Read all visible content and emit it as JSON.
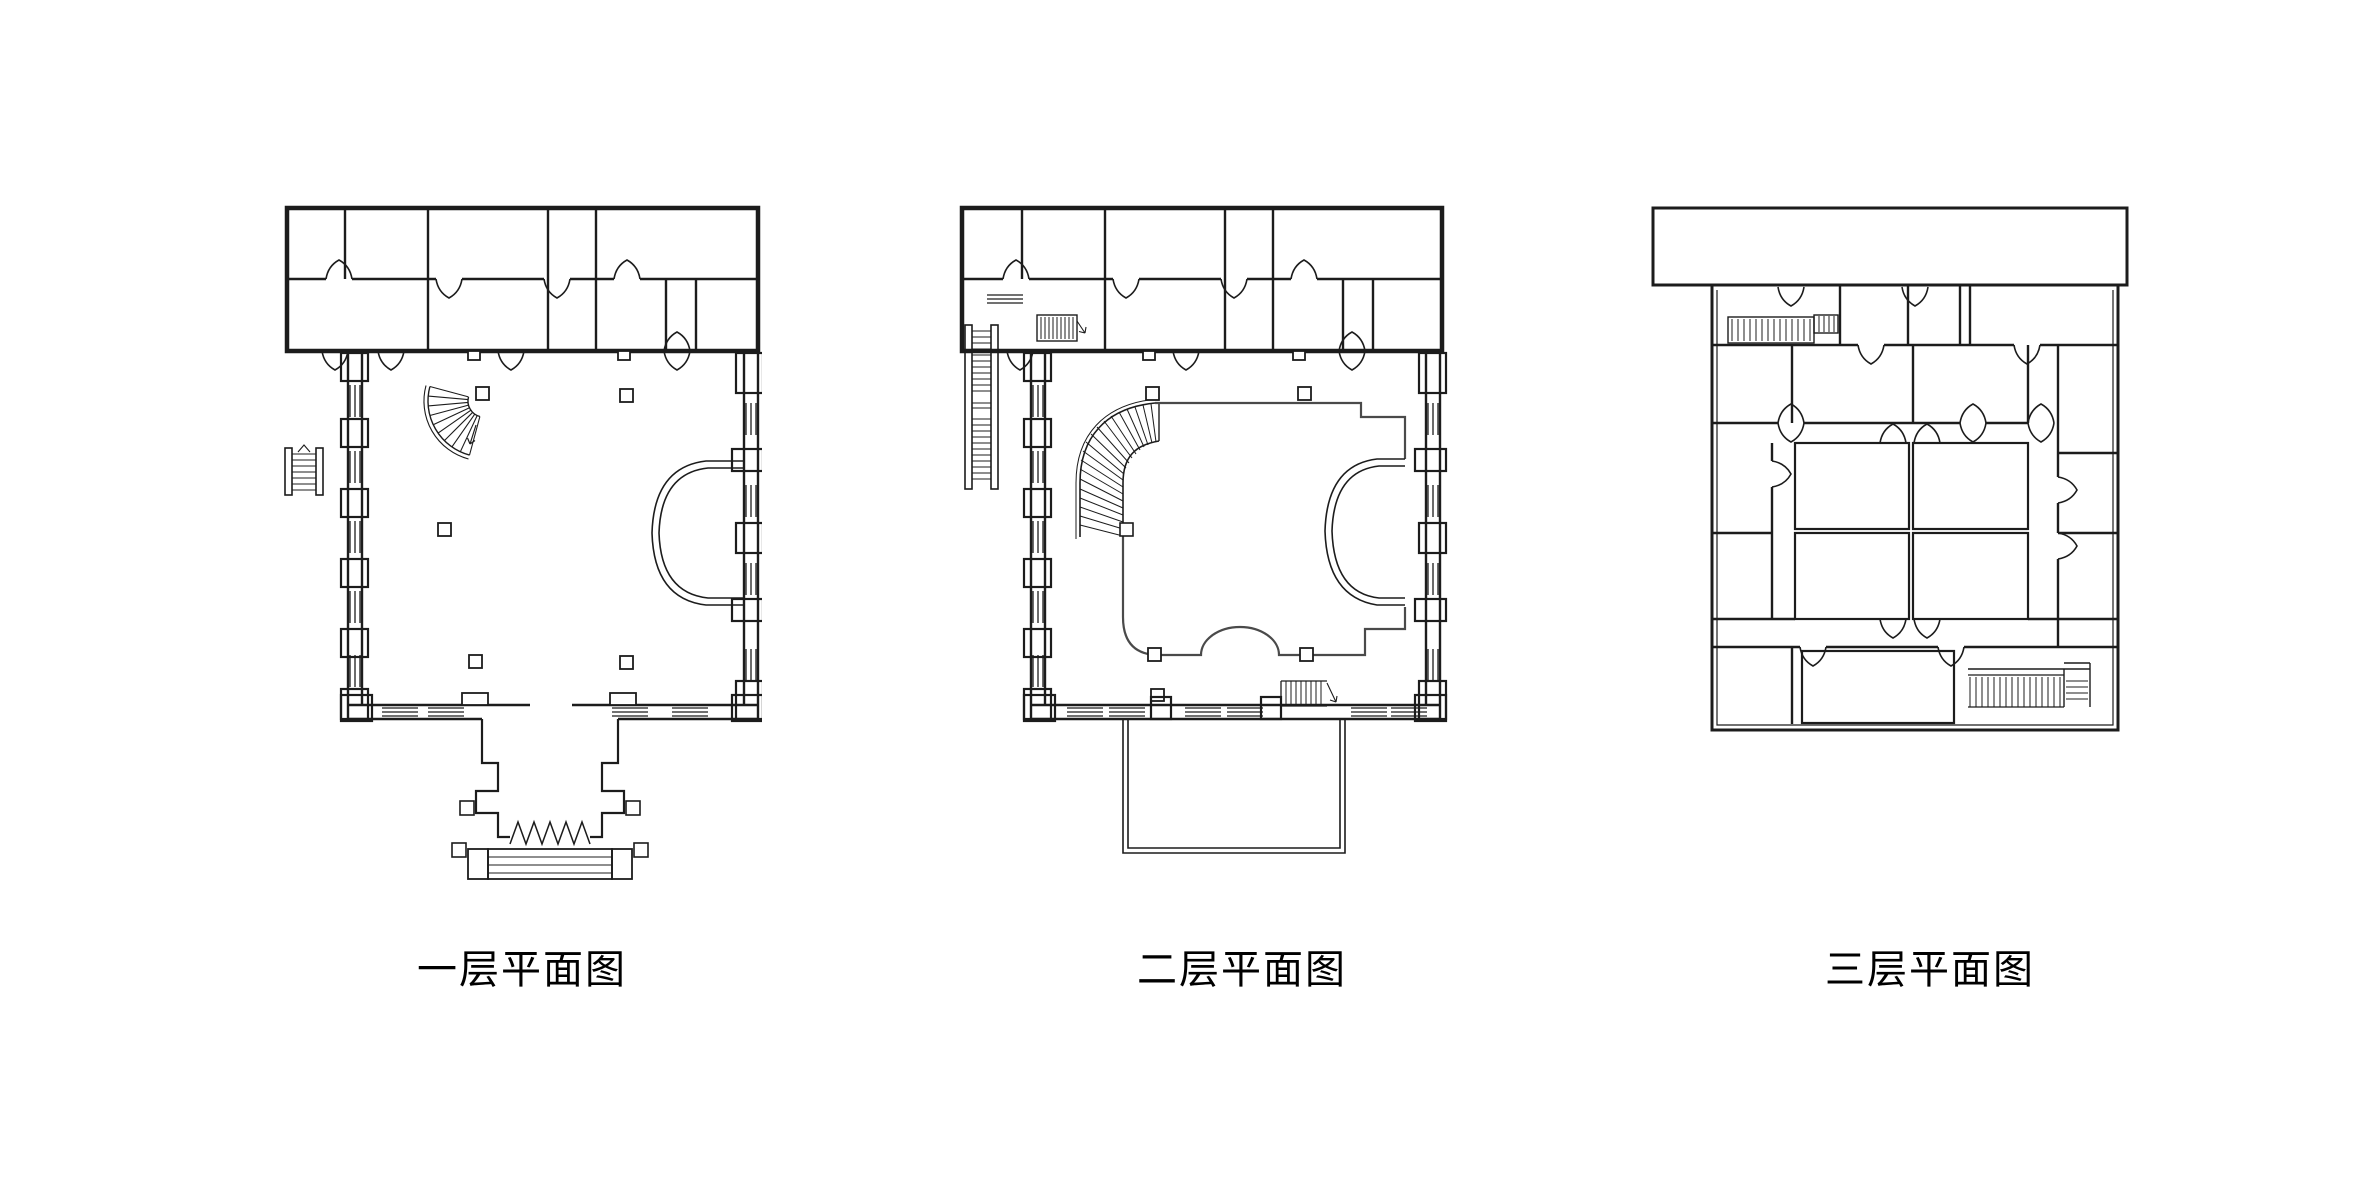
{
  "page": {
    "background_color": "#ffffff",
    "line_color": "#1c1c1c",
    "gallery_line_color": "#4a4a4a"
  },
  "plans": [
    {
      "id": "floor-1",
      "label": "一层平面图",
      "features": [
        "top-wing-rooms",
        "main-hall",
        "fan-staircase",
        "columns",
        "stage-apse",
        "entrance-portico",
        "entrance-steps",
        "exterior-stair",
        "windows",
        "door-swings"
      ]
    },
    {
      "id": "floor-2",
      "label": "二层平面图",
      "features": [
        "top-wing-rooms",
        "gallery-balcony",
        "grand-curved-staircase",
        "columns",
        "stage-apse",
        "side-exterior-stair",
        "small-stairs",
        "terrace",
        "windows",
        "door-swings"
      ]
    },
    {
      "id": "floor-3",
      "label": "三层平面图",
      "features": [
        "roof-band",
        "room-grid",
        "corridors",
        "staircases",
        "door-swings"
      ]
    }
  ]
}
